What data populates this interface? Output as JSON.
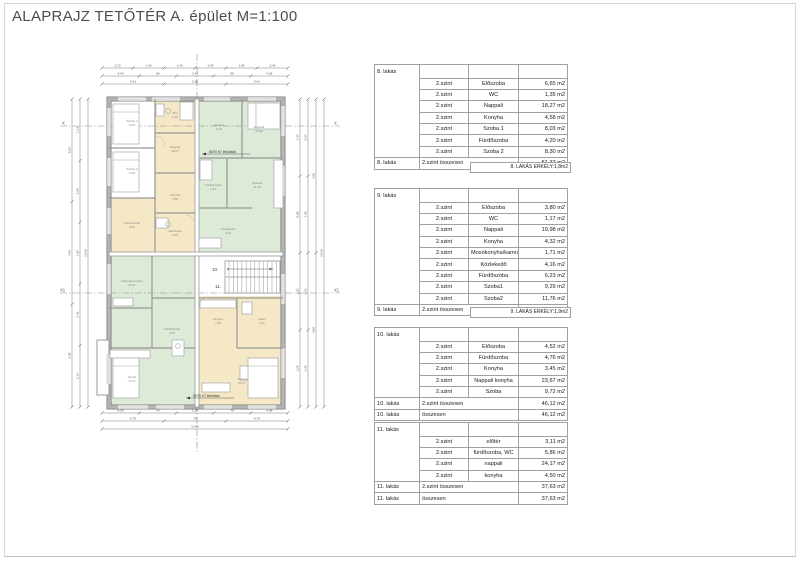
{
  "page": {
    "title": "ALAPRAJZ TETŐTÉR  A. épület M=1:100"
  },
  "plan": {
    "axis_labels": {
      "x_left": "X",
      "x_right": "X",
      "x1_left": "X1",
      "x1_right": "X1"
    },
    "apartment_markers": {
      "a10": "10.",
      "a11": "11."
    },
    "annotations": [
      {
        "text": "50/70 KT tetőablak"
      },
      {
        "text": "50/70 KT tetőablak"
      }
    ],
    "colors": {
      "apartment_yellow": "#f4e8c6",
      "apartment_green": "#dcead7",
      "wall_grey": "#b4b4b4"
    },
    "dims": {
      "top": [
        [
          "3,70",
          "1,40",
          "1,40",
          "2,45",
          "1,45",
          "2,43"
        ],
        [
          "4,44",
          "88",
          "2,43",
          "88",
          "4,28"
        ],
        [
          "5,41",
          "2,88",
          "5,41"
        ]
      ],
      "bottom": [
        [
          "4,05",
          "70",
          "1,35",
          "70",
          "4,05"
        ],
        [
          "6,75",
          "70",
          "6,75"
        ],
        [
          "13,60"
        ]
      ],
      "left": [
        [
          "3,53",
          "4,43",
          "2,95"
        ],
        [
          "1,13",
          "2,28",
          "1,90",
          "2,43",
          "1,13"
        ],
        [
          "10,33"
        ]
      ],
      "right": [
        [
          "1,44",
          "5,85",
          "1,50",
          "1,25"
        ],
        [
          "3,20",
          "1,45",
          "3,20",
          "1,45"
        ],
        [
          "4,65",
          "4,65"
        ],
        [
          "10,33"
        ]
      ]
    },
    "rooms": [
      {
        "n": "Szoba 1",
        "a": "8,03",
        "x": 80,
        "y": 74
      },
      {
        "n": "Szoba 2",
        "a": "8,30",
        "x": 80,
        "y": 122
      },
      {
        "n": "Fürdőszoba",
        "a": "4,20",
        "x": 80,
        "y": 176
      },
      {
        "n": "WC",
        "a": "1,35",
        "x": 123,
        "y": 66
      },
      {
        "n": "Nappali",
        "a": "18,27",
        "x": 123,
        "y": 100
      },
      {
        "n": "Konyha",
        "a": "4,58",
        "x": 123,
        "y": 148
      },
      {
        "n": "Előszoba",
        "a": "6,65",
        "x": 123,
        "y": 184
      },
      {
        "n": "Szoba1",
        "a": "9,29",
        "x": 167,
        "y": 78
      },
      {
        "n": "Nappali",
        "a": "19,98",
        "x": 207,
        "y": 80
      },
      {
        "n": "Fürdőszoba",
        "a": "6,23",
        "x": 161,
        "y": 138
      },
      {
        "n": "Szoba2",
        "a": "11,76",
        "x": 205,
        "y": 136
      },
      {
        "n": "Közlekedő",
        "a": "4,16",
        "x": 176,
        "y": 182
      },
      {
        "n": "Nappali konyha",
        "a": "23,67",
        "x": 80,
        "y": 234
      },
      {
        "n": "Fürdőszoba",
        "a": "4,76",
        "x": 120,
        "y": 282
      },
      {
        "n": "Szoba",
        "a": "9,72",
        "x": 80,
        "y": 330
      },
      {
        "n": "konyha",
        "a": "4,50",
        "x": 166,
        "y": 272
      },
      {
        "n": "előtér",
        "a": "3,11",
        "x": 210,
        "y": 272
      },
      {
        "n": "nappali",
        "a": "24,17",
        "x": 190,
        "y": 332
      }
    ]
  },
  "tables": [
    {
      "id": "8. lakás",
      "level": "2.szint",
      "rows": [
        [
          "Előszoba",
          "6,65 m2"
        ],
        [
          "WC",
          "1,35 m2"
        ],
        [
          "Nappali",
          "18,27 m2"
        ],
        [
          "Konyha",
          "4,58 m2"
        ],
        [
          "Szoba 1",
          "8,03 m2"
        ],
        [
          "Fürdőszoba",
          "4,20 m2"
        ],
        [
          "Szoba 2",
          "8,30 m2"
        ]
      ],
      "total_label": "2.szint összesen",
      "total_value": "51,37 m2",
      "footer": "8. LAKÁS ERKÉLY:1,8m2"
    },
    {
      "id": "9. lakás",
      "level": "2.szint",
      "rows": [
        [
          "Előszoba",
          "3,80 m2"
        ],
        [
          "WC",
          "1,17 m2"
        ],
        [
          "Nappali",
          "19,98 m2"
        ],
        [
          "Konyha",
          "4,32 m2"
        ],
        [
          "Mosókonyha/kamra",
          "1,71 m2"
        ],
        [
          "Közlekedő",
          "4,16 m2"
        ],
        [
          "Fürdőszoba",
          "6,23 m2"
        ],
        [
          "Szoba1",
          "9,29 m2"
        ],
        [
          "Szoba2",
          "11,76 m2"
        ]
      ],
      "total_label": "2.szint összesen",
      "total_value": "62,42 m2",
      "footer": "9. LAKÁS ERKÉLY:1,9m2"
    },
    {
      "id": "10. lakás",
      "level": "2.szint",
      "rows": [
        [
          "Előszoba",
          "4,52 m2"
        ],
        [
          "Fürdőszoba",
          "4,76 m2"
        ],
        [
          "Konyha",
          "3,45 m2"
        ],
        [
          "Nappali konyha",
          "23,67 m2"
        ],
        [
          "Szoba",
          "9,72 m2"
        ]
      ],
      "total_label": "2.szint összesen",
      "total_value": "46,12 m2",
      "grand_label": "összesen",
      "grand_value": "46,12 m2"
    },
    {
      "id": "11. lakás",
      "level": "2.szint",
      "rows": [
        [
          "előtér",
          "3,11 m2"
        ],
        [
          "fürdőszoba, WC",
          "5,86 m2"
        ],
        [
          "nappali",
          "24,17 m2"
        ],
        [
          "konyha",
          "4,50 m2"
        ]
      ],
      "total_label": "2.szint összesen",
      "total_value": "37,63 m2",
      "grand_label": "összesen",
      "grand_value": "37,63 m2"
    }
  ]
}
